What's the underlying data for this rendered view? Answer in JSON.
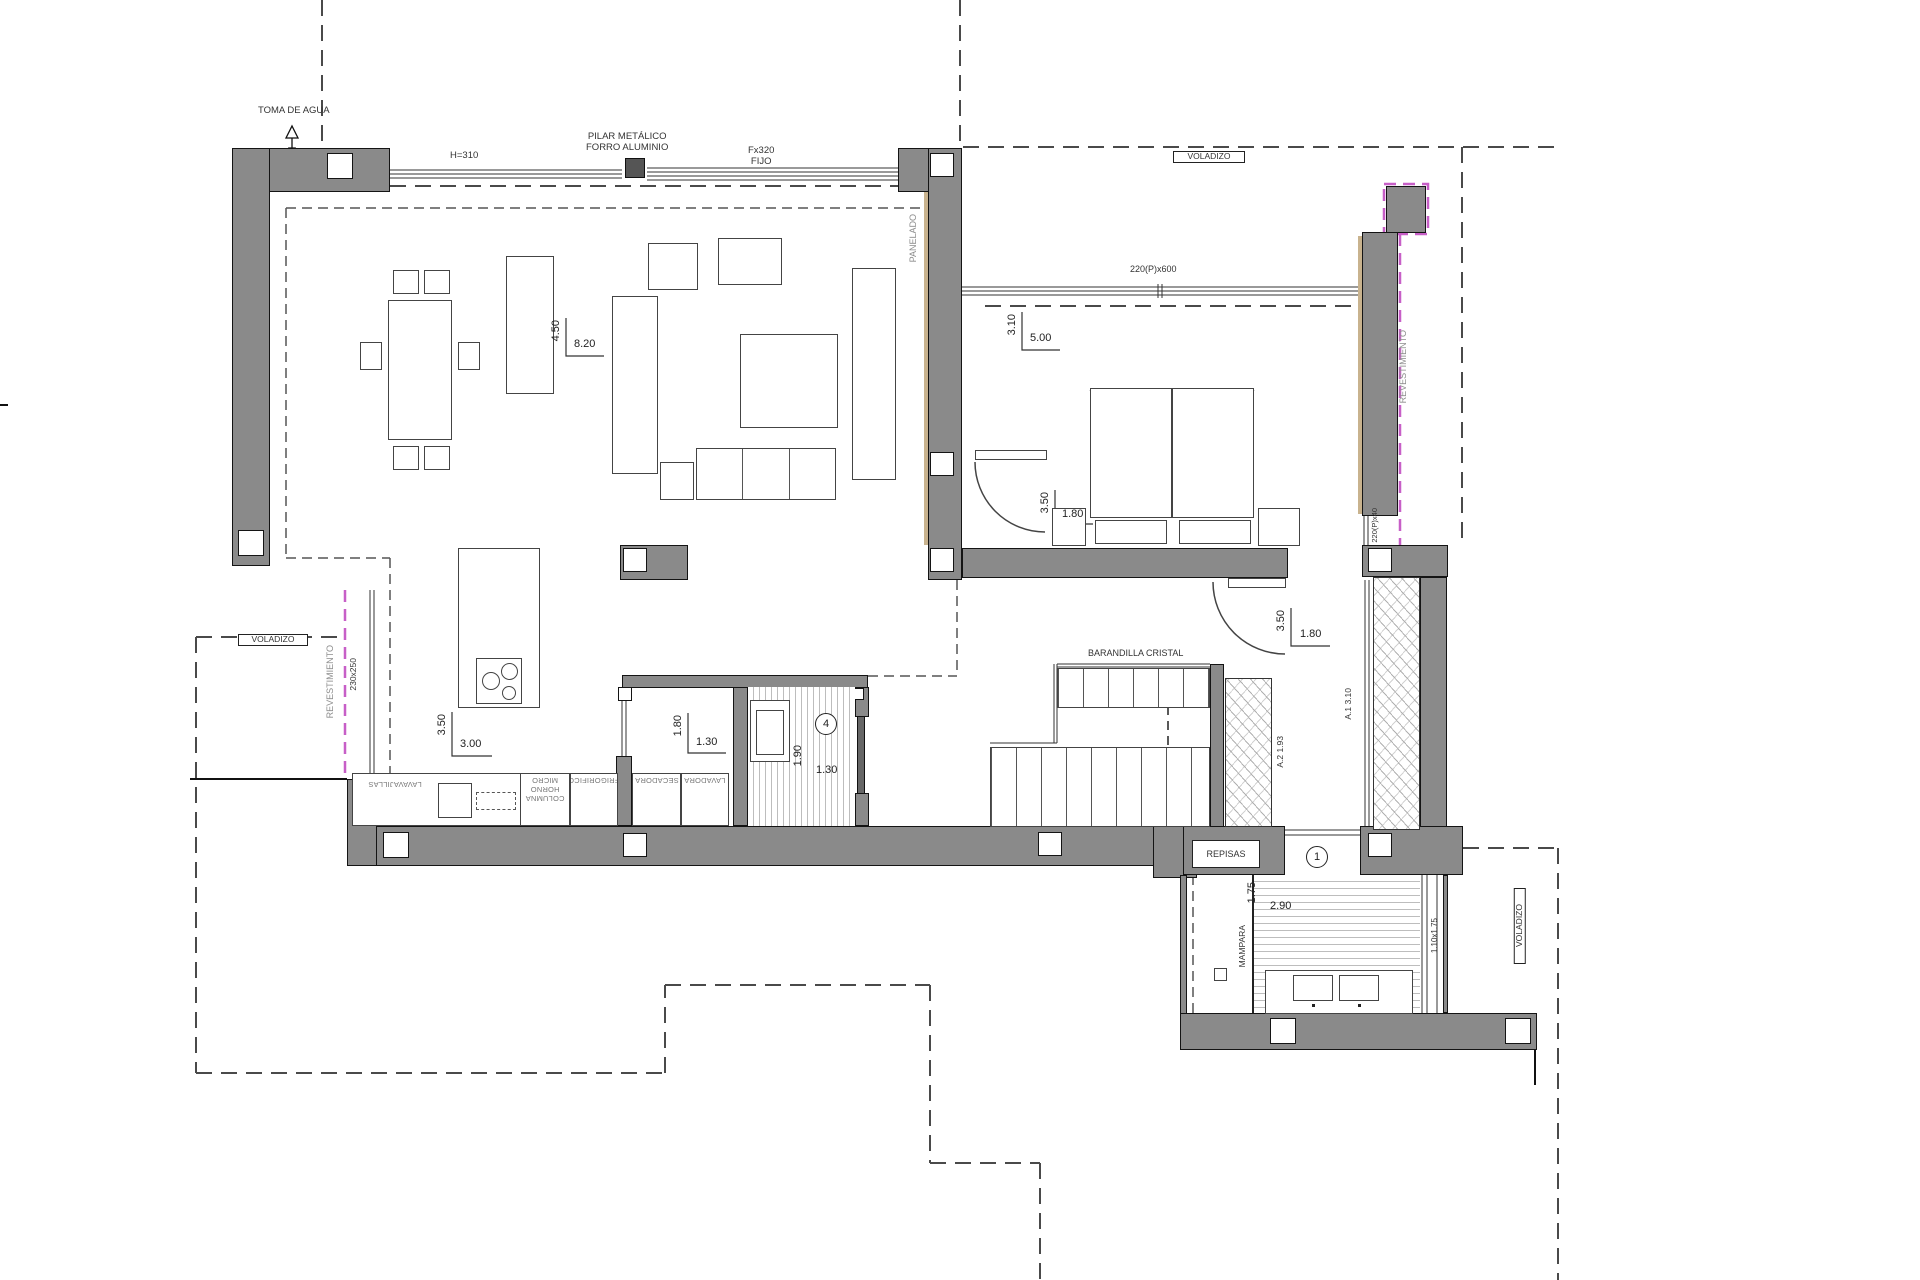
{
  "plan": {
    "labels": {
      "toma_de_agua": "TOMA DE AGUA",
      "h310": "H=310",
      "pilar_1": "PILAR METÁLICO",
      "pilar_2": "FORRO ALUMINIO",
      "fijo_1": "Fx320",
      "fijo_2": "FIJO",
      "voladizo": "VOLADIZO",
      "window_bedroom": "220(P)x600",
      "window_small": "220(P)x40",
      "window_bath": "1.10x1.75",
      "revestimiento": "REVESTIMIENTO",
      "cladding_size": "230x250",
      "panelado": "PANELADO",
      "barandilla": "BARANDILLA CRISTAL",
      "repisas": "REPISAS",
      "mampara": "MAMPARA",
      "wardrobe_a1": "A.1 3.10",
      "wardrobe_a2": "A.2 1.93",
      "bath_main_num": "1",
      "bath_guest_num": "4"
    },
    "dimensions": {
      "living": {
        "v": "4.50",
        "h": "8.20"
      },
      "bedroom": {
        "v": "3.10",
        "h": "5.00"
      },
      "kitchen": {
        "v": "3.50",
        "h": "3.00"
      },
      "laundry": {
        "v": "1.80",
        "h": "1.30"
      },
      "bath_guest": {
        "v": "1.90",
        "h": "1.30"
      },
      "bath_main": {
        "v": "1.75",
        "h": "2.90"
      },
      "door_bedroom": {
        "v": "3.50",
        "h": "1.80"
      },
      "door_entry": {
        "v": "3.50",
        "h": "1.80"
      }
    },
    "appliances": {
      "dishwasher": "LAVAVAJILLAS",
      "column": "COLUMNA HORNO MICRO",
      "fridge": "FRIGORIFICO",
      "dryer": "SECADORA",
      "washer": "LAVADORA"
    },
    "colors": {
      "wall": "#8a8a8a",
      "magenta": "#c75fc7",
      "tan": "#c9b38e"
    }
  }
}
